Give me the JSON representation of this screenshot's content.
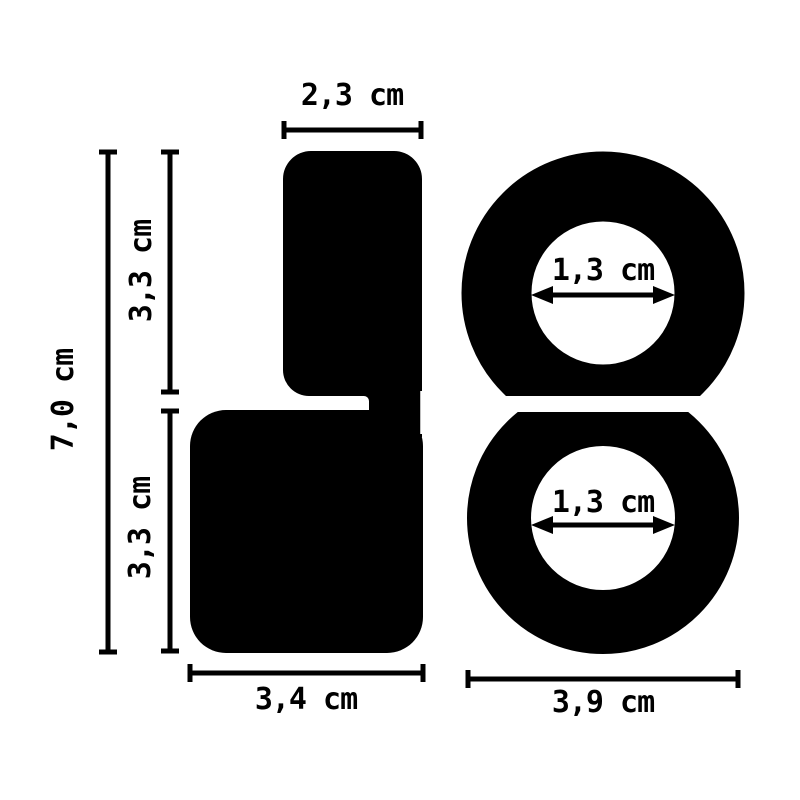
{
  "page": {
    "background_color": "#ffffff",
    "ink_color": "#000000"
  },
  "diagram": {
    "type": "product-dimension-diagram",
    "unit": "cm",
    "profile_view": {
      "description": "side profile silhouette of two stacked rings",
      "top_width_label": "2,3 cm",
      "upper_section_height_label": "3,3 cm",
      "lower_section_height_label": "3,3 cm",
      "total_height_label": "7,0 cm",
      "base_width_label": "3,4 cm"
    },
    "front_view": {
      "description": "front view of two rings with inner diameter arrows",
      "top_ring_inner_diameter_label": "1,3 cm",
      "bottom_ring_inner_diameter_label": "1,3 cm",
      "bottom_ring_outer_width_label": "3,9 cm"
    }
  }
}
